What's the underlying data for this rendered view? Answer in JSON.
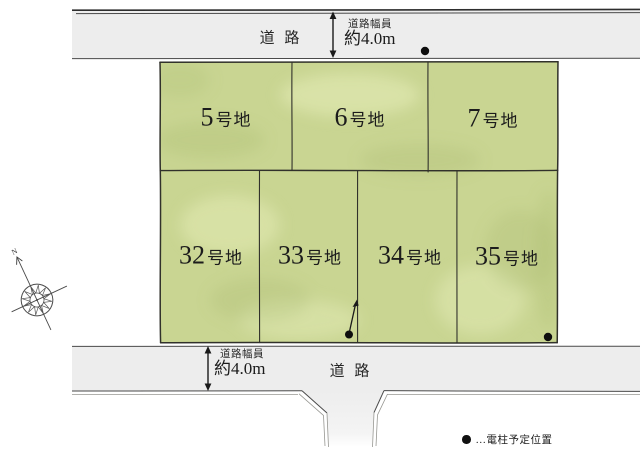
{
  "roads": {
    "top": {
      "name": "道 路",
      "width_label": "道路幅員",
      "width_value": "約4.0m"
    },
    "bottom": {
      "name": "道 路",
      "width_label": "道路幅員",
      "width_value": "約4.0m"
    }
  },
  "lots": {
    "top_row": [
      {
        "num": "5",
        "suffix": "号地"
      },
      {
        "num": "6",
        "suffix": "号地"
      },
      {
        "num": "7",
        "suffix": "号地"
      }
    ],
    "bottom_row": [
      {
        "num": "32",
        "suffix": "号地"
      },
      {
        "num": "33",
        "suffix": "号地"
      },
      {
        "num": "34",
        "suffix": "号地"
      },
      {
        "num": "35",
        "suffix": "号地"
      }
    ]
  },
  "compass": {
    "north_label": "N"
  },
  "legend": {
    "text": "…電柱予定位置"
  },
  "colors": {
    "lot_fill": "#c9d592",
    "road_fill": "#ededed",
    "outline": "#31312b",
    "marker": "#0e0e0e"
  }
}
